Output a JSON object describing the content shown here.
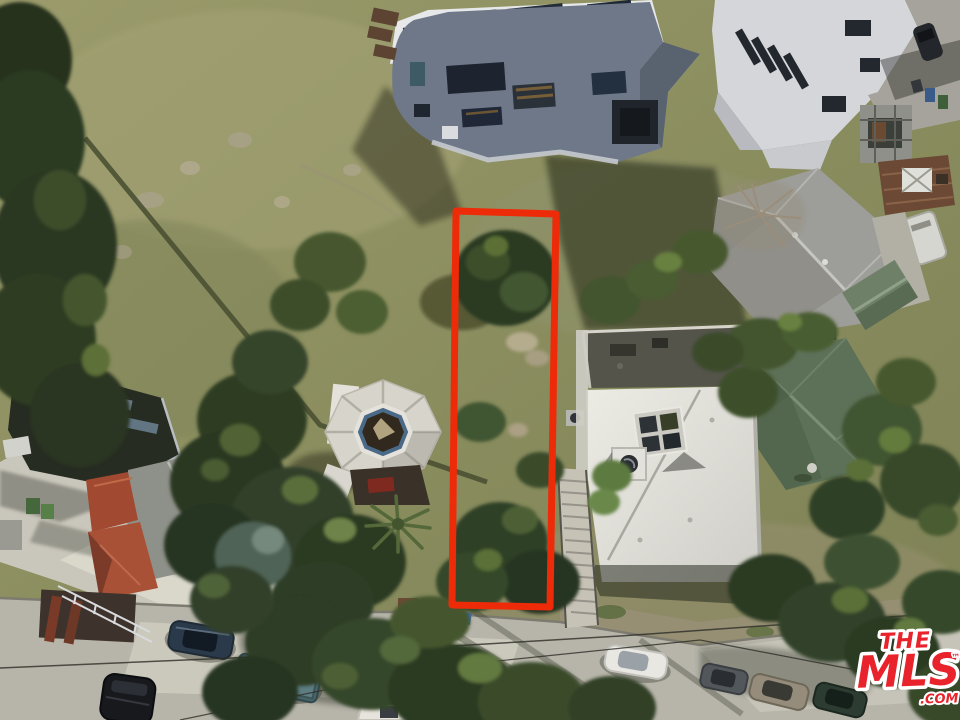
{
  "image": {
    "kind": "aerial drone photograph, hillside residential neighborhood",
    "purpose": "real-estate listing photo highlighting a vacant lot with a red boundary overlay"
  },
  "parcel": {
    "points": "456,211 556,214 550,607 452,605",
    "outline_color": "#ee2b08",
    "outline_width": "7"
  },
  "watermark": {
    "brand_line1": "THE",
    "brand_line2": "MLS",
    "trademark": "™",
    "domain_suffix": ".COM",
    "color": "#e8232b",
    "outline_color": "#ffffff"
  },
  "scene": {
    "features": [
      "multi-story blue-gray house with white roof and solar panels",
      "white modern house (top right)",
      "gray shingle hip-roof house",
      "concrete driveway with trash bins and scaffolding",
      "brown rooftop deck with white skylight unit",
      "white camper trailer",
      "sage-green hip-roof house",
      "green garden shed",
      "large white flat roof with skylight and vent fan",
      "dark gravel flat roof",
      "octagonal-roof house with central skylight",
      "dark flat-roof house with skylight strips",
      "gray gable-roof house",
      "red tile-roof house",
      "long outdoor staircase beside the lot",
      "street along bottom with parked cars",
      "dry grass hillside with rocks and shadows",
      "dense trees and brush"
    ],
    "vehicles": [
      "dark blue sedan",
      "teal pickup truck",
      "black SUV",
      "white sedan",
      "gray car",
      "tan sedan",
      "dark green sedan",
      "dark car in upper driveway"
    ]
  }
}
